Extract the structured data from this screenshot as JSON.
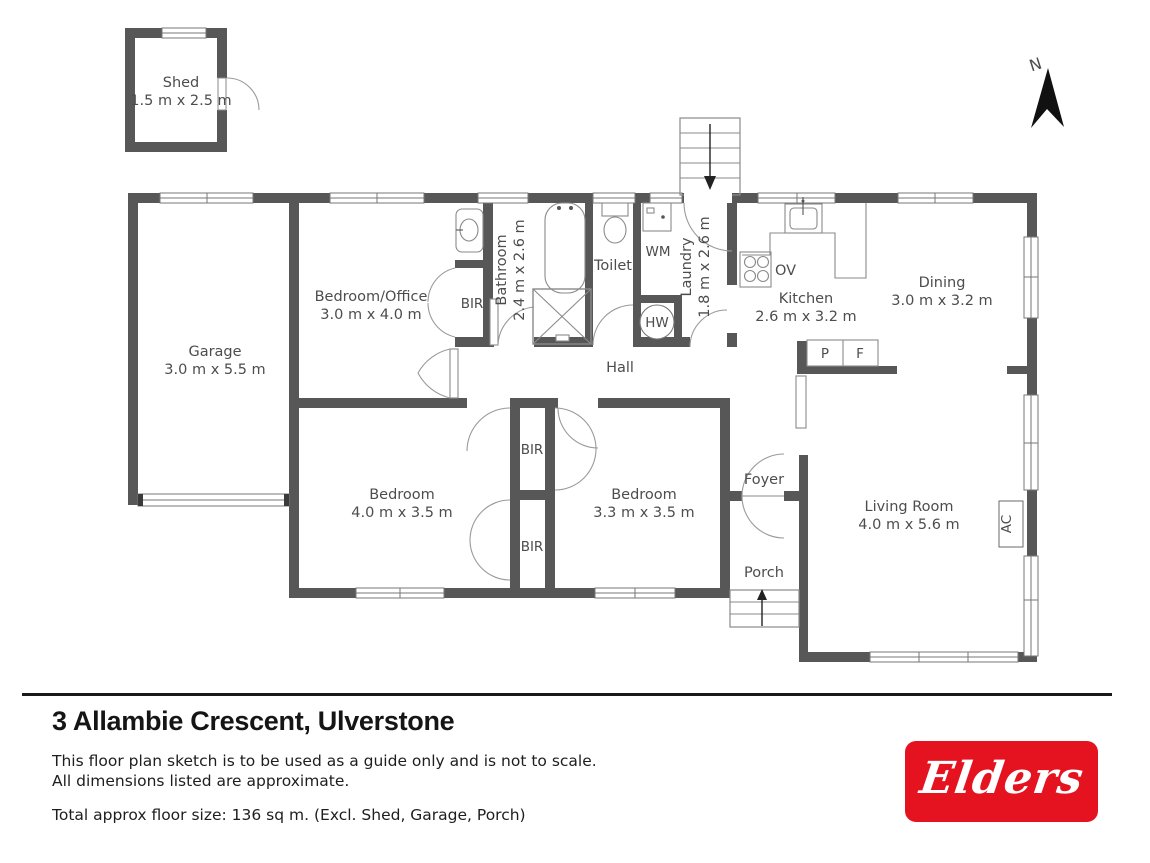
{
  "plan": {
    "rooms": {
      "shed": {
        "name": "Shed",
        "dims": "1.5 m x 2.5 m"
      },
      "garage": {
        "name": "Garage",
        "dims": "3.0 m x 5.5 m"
      },
      "bedroom_office": {
        "name": "Bedroom/Office",
        "dims": "3.0 m x 4.0 m"
      },
      "bathroom": {
        "name": "Bathroom",
        "dims": "2.4 m x 2.6 m"
      },
      "toilet": {
        "name": "Toilet"
      },
      "laundry": {
        "name": "Laundry",
        "dims": "1.8 m x 2.6 m"
      },
      "kitchen": {
        "name": "Kitchen",
        "dims": "2.6 m x 3.2 m"
      },
      "dining": {
        "name": "Dining",
        "dims": "3.0 m x 3.2 m"
      },
      "hall": {
        "name": "Hall"
      },
      "bedroom_main": {
        "name": "Bedroom",
        "dims": "4.0 m x 3.5 m"
      },
      "bedroom_second": {
        "name": "Bedroom",
        "dims": "3.3 m x 3.5 m"
      },
      "foyer": {
        "name": "Foyer"
      },
      "living": {
        "name": "Living Room",
        "dims": "4.0 m x 5.6 m"
      },
      "porch": {
        "name": "Porch"
      }
    },
    "markers": {
      "bir": "BIR",
      "wm": "WM",
      "hw": "HW",
      "ov": "OV",
      "pantry": "P",
      "fridge": "F",
      "ac": "AC",
      "north": "N"
    }
  },
  "footer": {
    "title": "3 Allambie Crescent, Ulverstone",
    "disclaimer_line1": "This floor plan sketch is to be used as a guide only and is not to scale.",
    "disclaimer_line2": "All dimensions listed are approximate.",
    "total": "Total approx floor size: 136 sq m. (Excl. Shed, Garage, Porch)",
    "brand": "Elders"
  },
  "colors": {
    "wall": "#575757",
    "brand_red": "#e4131f",
    "label": "#4d4d4d"
  }
}
